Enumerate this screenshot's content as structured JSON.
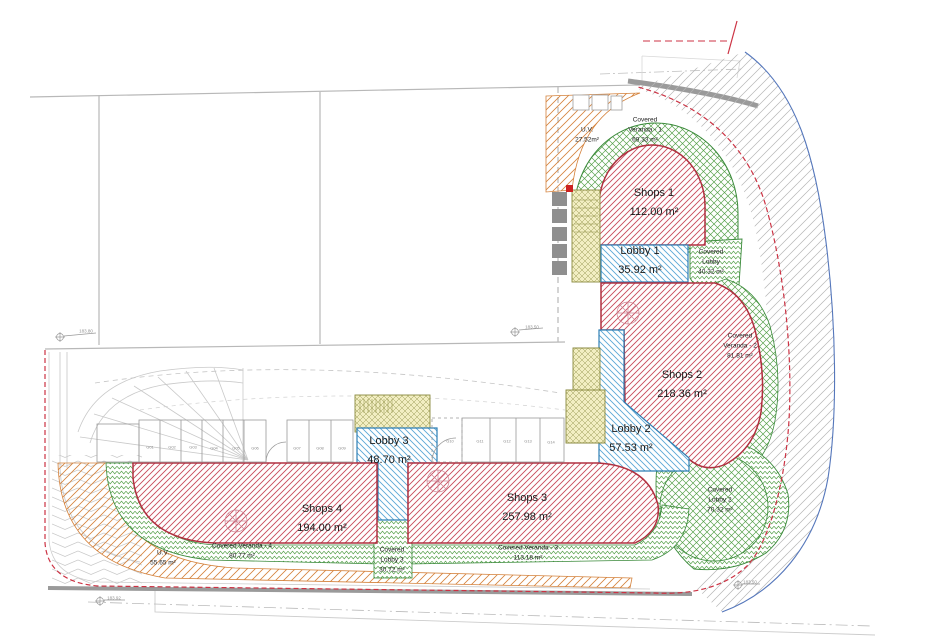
{
  "plan": {
    "zones": {
      "shops_1": {
        "label": "Shops 1",
        "area": "112.00 m²"
      },
      "shops_2": {
        "label": "Shops 2",
        "area": "218.36 m²"
      },
      "shops_3": {
        "label": "Shops 3",
        "area": "257.98 m²"
      },
      "shops_4": {
        "label": "Shops 4",
        "area": "194.00 m²"
      },
      "lobby_1": {
        "label": "Lobby 1",
        "area": "35.92 m²"
      },
      "lobby_2": {
        "label": "Lobby 2",
        "area": "57.53 m²"
      },
      "lobby_3": {
        "label": "Lobby 3",
        "area": "48.70 m²"
      },
      "uv_top": {
        "label": "U.V.",
        "area": "27.52m²"
      },
      "uv_bottom": {
        "label": "U.V.",
        "area": "55.65 m²"
      },
      "covered_veranda_1": {
        "line1": "Covered",
        "line2": "Veranda - 1",
        "area": "69.33 m²"
      },
      "covered_lobby_1": {
        "line1": "Covered",
        "line2": "Lobby",
        "area": "40.32 m²"
      },
      "covered_veranda_2": {
        "line1": "Covered",
        "line2": "Veranda - 2",
        "area": "81.81 m²"
      },
      "covered_lobby_2": {
        "line1": "Covered",
        "line2": "Lobby 2",
        "area": "70.32 m²"
      },
      "covered_lobby_3": {
        "line1": "Covered",
        "line2": "Lobby 3",
        "area": "30.72 m²"
      },
      "covered_veranda_3": {
        "line1": "Covered Veranda - 3",
        "area": "113.18 m²"
      },
      "covered_veranda_4": {
        "line1": "Covered Veranda - 4",
        "area": "80.77 m²"
      }
    },
    "parking_stalls": [
      "G01",
      "G02",
      "G03",
      "G04",
      "G05",
      "G06",
      "G07",
      "G08",
      "G09",
      "G10",
      "G11",
      "G12",
      "G13",
      "G14"
    ],
    "survey_markers": [
      "183.80",
      "183.50",
      "183.92",
      "183.50"
    ],
    "colors": {
      "shops_hatch": "#c84a5a",
      "lobby_hatch": "#5aa7d6",
      "covered_green": "#55a04a",
      "uv_orange": "#d4823c",
      "stair_fill": "#f2eec2",
      "boundary_red": "#cc3344",
      "road_blue": "#5577bb",
      "line_gray": "#b5b5b5"
    }
  }
}
